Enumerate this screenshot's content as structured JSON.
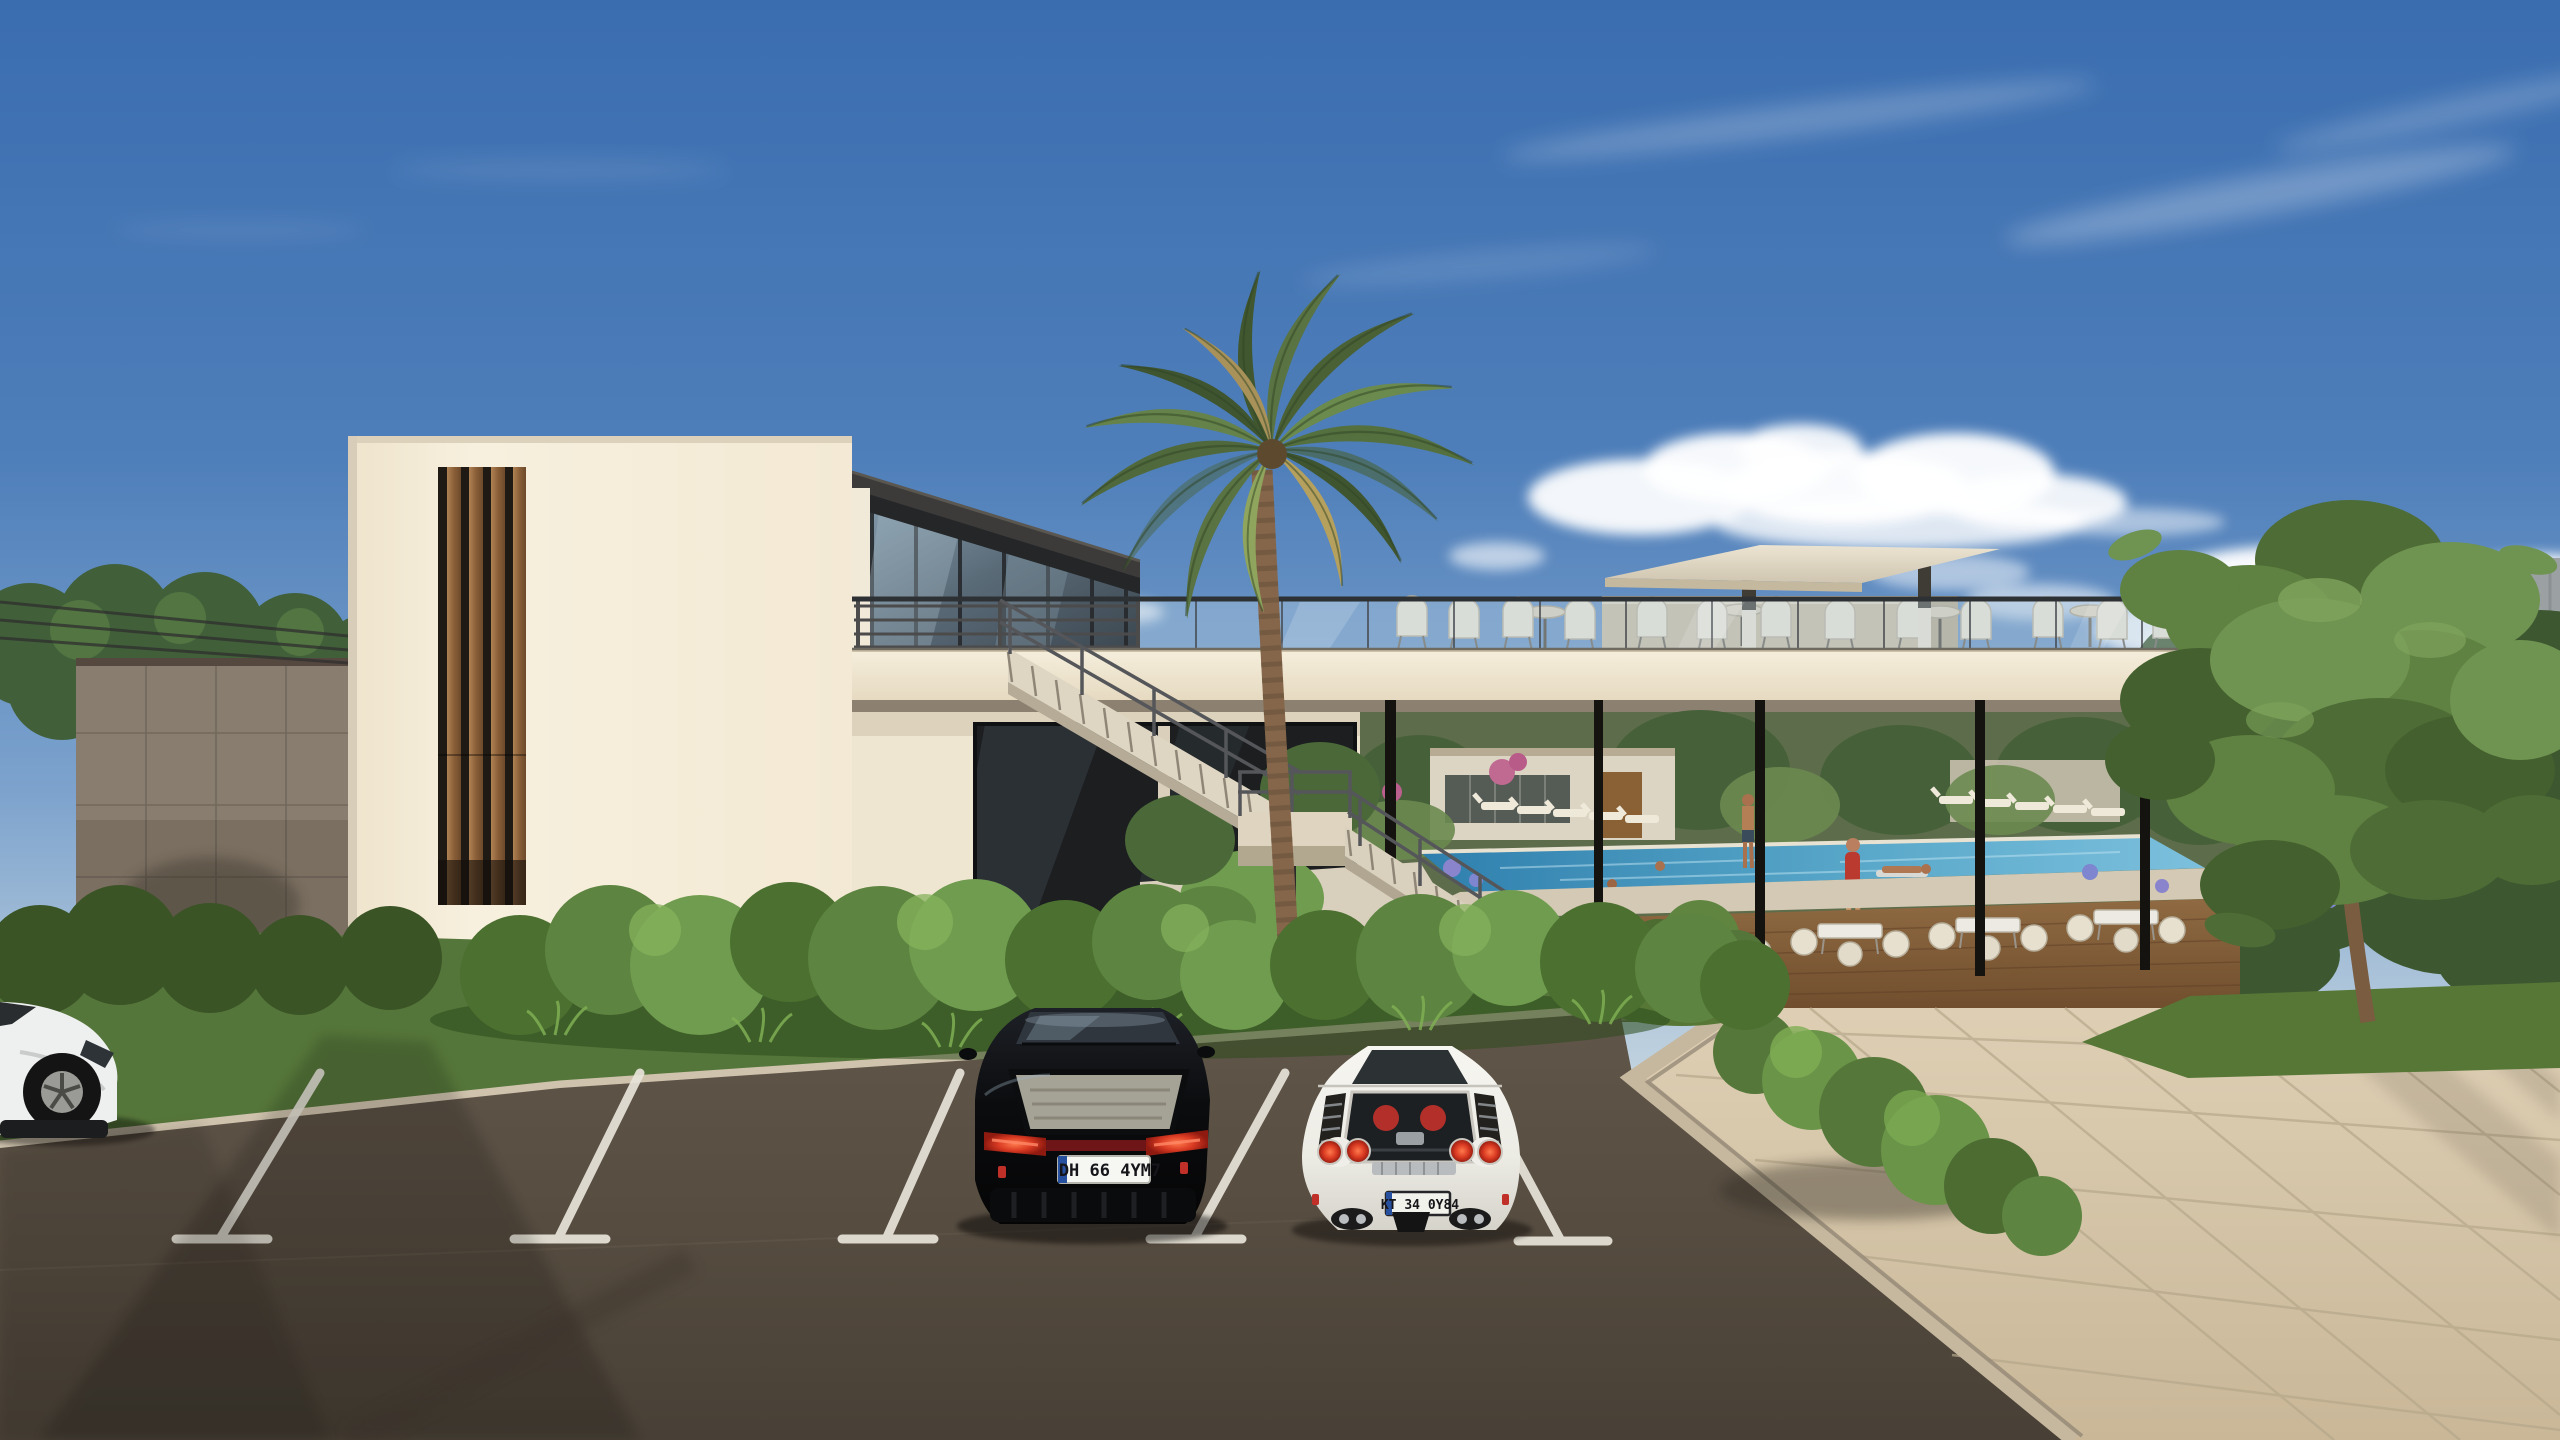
{
  "scene": {
    "description": "Daytime 3D architectural rendering of a modern white beach-club building with rooftop terrace, pool courtyard under an elevated deck, palm tree, large green tree, hedges and a foreground parking lot with parked cars",
    "time_of_day": "day",
    "sky": {
      "top_color": "#3a6db0",
      "horizon_color": "#d9e2e6",
      "cloud_color": "#ffffff"
    },
    "building": {
      "facade_color": "#f4ecd9",
      "wood_slats_color": "#9a6f45",
      "roof_color": "#3c3b3a",
      "deck_band_color": "#f1e8d4",
      "boundary_wall_color": "#897d6f",
      "canopy_color": "#e3dac6"
    },
    "courtyard": {
      "pool_color": "#3f8fba",
      "wood_deck_color": "#7a5634",
      "furniture_color": "#e9e2d2"
    },
    "ground": {
      "asphalt_color": "#584d41",
      "plaza_color": "#d5c4a8",
      "grass_color": "#567736",
      "hedge_color": "#55783a",
      "stripe_color": "#e8e4da",
      "curb_color": "#cfc3ad"
    },
    "vegetation": {
      "palm_green": "#5a7342",
      "tree_green": "#5f8142"
    }
  },
  "vehicles": {
    "suv": {
      "type": "black SUV, rear view",
      "body_color": "#0b0c0e",
      "plate": "DH 66 4YM7",
      "plate_band_color": "#27509e"
    },
    "sports_car": {
      "type": "white sports car, rear view",
      "body_color": "#f2f1ec",
      "plate": "KT 34 0Y84"
    },
    "edge_car": {
      "type": "white car partially visible at left edge",
      "body_color": "#eef0ef"
    }
  }
}
